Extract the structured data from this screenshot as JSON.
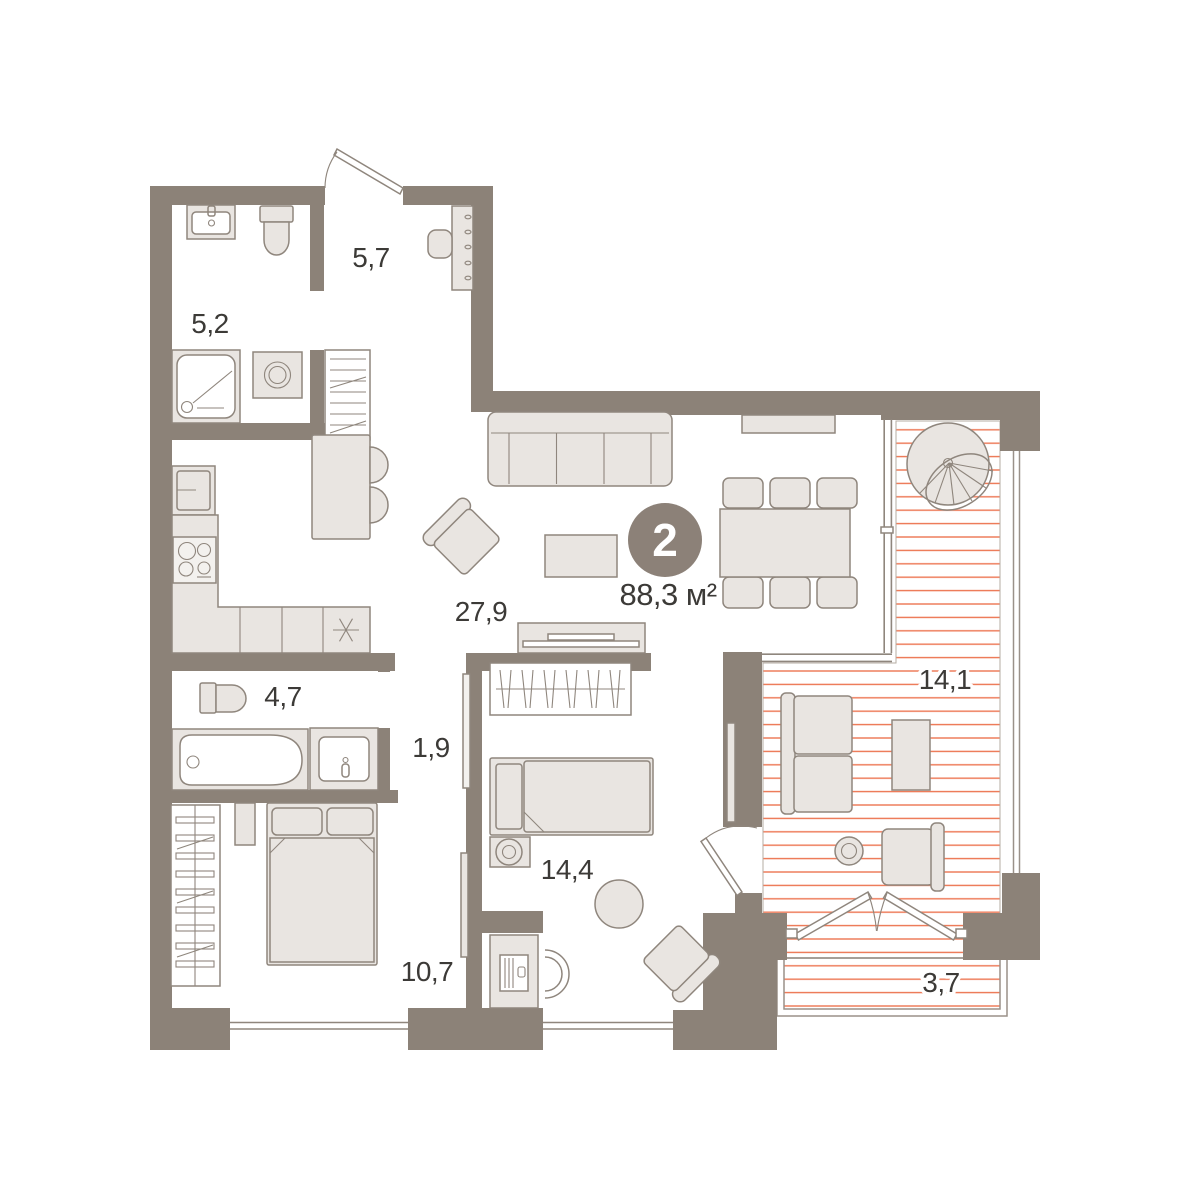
{
  "floorplan": {
    "badge": {
      "rooms_count": "2",
      "total_area": "88,3 м²"
    },
    "room_labels": {
      "hallway": "5,7",
      "bathroom_top": "5,2",
      "living_kitchen": "27,9",
      "bathroom_mid": "4,7",
      "corridor": "1,9",
      "bedroom_left": "10,7",
      "bedroom_mid": "14,4",
      "terrace": "14,1",
      "balcony": "3,7"
    },
    "colors": {
      "wall": "#8c8278",
      "furniture": "#e9e5e1",
      "furniture-light": "#f3f1ee",
      "line": "#8f867d",
      "hatch": "#ec7450",
      "hatch-border": "#b5aca3",
      "glass": "#8f867d",
      "text": "#3c3a37",
      "badge-bg": "#8c8178",
      "badge-text": "#ffffff",
      "rail": "#9a9189"
    }
  }
}
